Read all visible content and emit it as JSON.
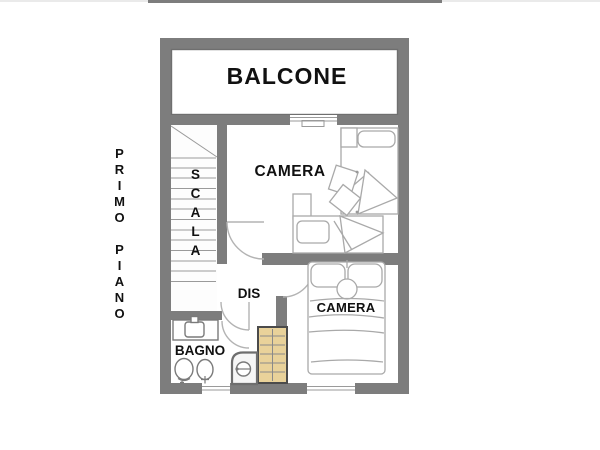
{
  "plan": {
    "floor_label": "PRIMO PIANO",
    "rooms": {
      "balcone": {
        "label": "BALCONE"
      },
      "scala": {
        "label": "SCALA"
      },
      "camera_top": {
        "label": "CAMERA"
      },
      "camera_bottom": {
        "label": "CAMERA"
      },
      "dis": {
        "label": "DIS"
      },
      "bagno": {
        "label": "BAGNO"
      }
    },
    "furniture_icons": {
      "camera_top": [
        "single-bed-icon",
        "single-bed-icon",
        "nightstand-icon",
        "desk-icon",
        "chair-icon"
      ],
      "camera_bottom": [
        "double-bed-icon",
        "pillow-icon",
        "pillow-icon",
        "round-cushion-icon",
        "wardrobe-icon"
      ],
      "bagno": [
        "sink-icon",
        "toilet-icon",
        "bidet-icon",
        "shower-icon"
      ],
      "scala": [
        "stairs-icon"
      ]
    },
    "openings": {
      "balcony_door": 1,
      "interior_door_arcs": 3,
      "bottom_wall_windows": 2
    }
  },
  "colors": {
    "wall": "#7d7d7d",
    "wallline": "#6f6f6f",
    "sketch": "#a9a9a9",
    "fixture": "#7a7a7a",
    "stair": "#9a9a9a",
    "doorarc": "#b3b3b3",
    "wardrobe": "#e9d29a",
    "wardrobe_border": "#4b4b4b",
    "wardrobe_line": "#8a8a8a",
    "ink": "#111111"
  }
}
